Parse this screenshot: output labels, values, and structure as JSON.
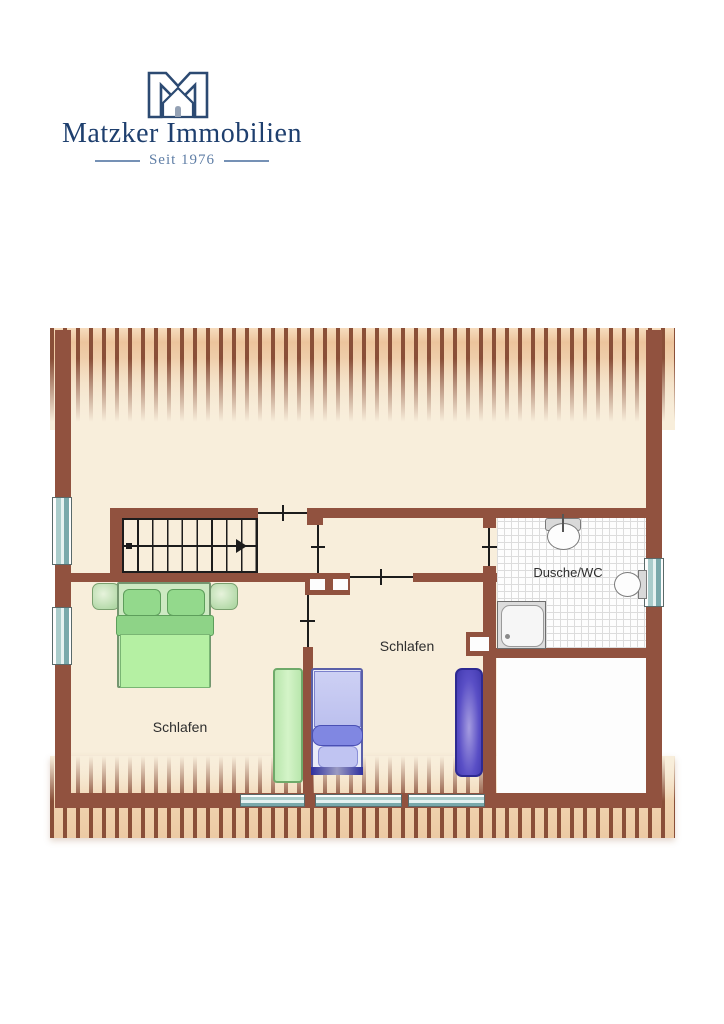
{
  "logo": {
    "name": "Matzker Immobilien",
    "tagline": "Seit 1976",
    "icon": "house-m-logo",
    "navy": "#1e3f6e",
    "tagline_color": "#5f7ea6"
  },
  "plan": {
    "type": "attic-floor-plan",
    "rooms": [
      {
        "id": "bedroom-left",
        "label": "Schlafen"
      },
      {
        "id": "bedroom-middle",
        "label": "Schlafen"
      },
      {
        "id": "bathroom",
        "label": "Dusche/WC"
      }
    ],
    "fixtures": [
      "staircase-icon",
      "sink-icon",
      "toilet-icon",
      "shower-tray-icon",
      "double-bed-icon",
      "single-bed-icon",
      "wardrobe-green-icon",
      "wardrobe-purple-icon",
      "chimney-icon",
      "window-icon",
      "roof-slope-hatch"
    ],
    "window_count": 6,
    "colors": {
      "wall": "#91523f",
      "floor": "#f8eedb",
      "roof_hatch": "#8a4f38",
      "window_glass": "#79a9ab",
      "bed_green": "#b5f0a3",
      "bed_blue": "#c5c8f0",
      "wardrobe_purple": "#5a4fc6",
      "bath_tile": "#fdfdfd"
    }
  }
}
